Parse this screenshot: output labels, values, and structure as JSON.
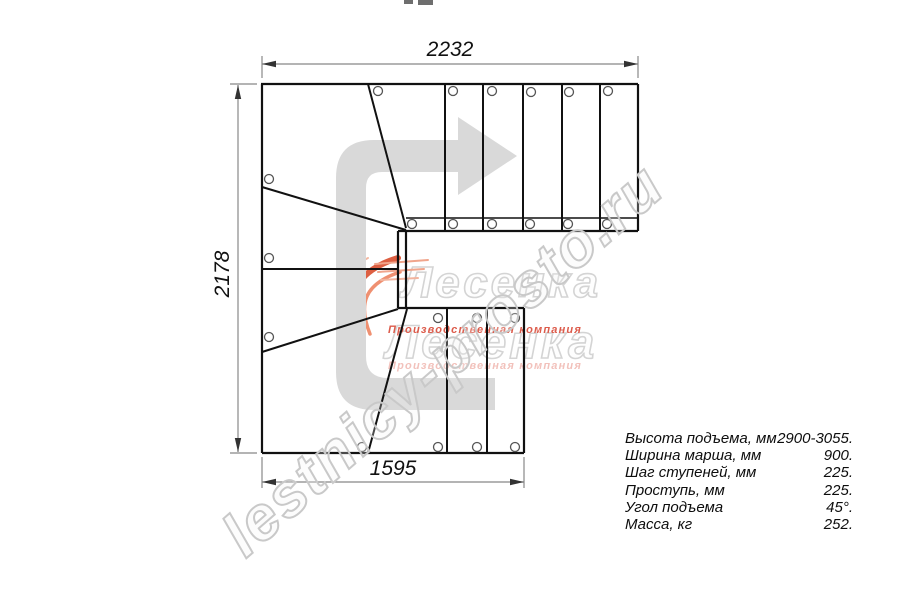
{
  "drawing": {
    "dimension_labels": {
      "top": "2232",
      "left": "2178",
      "bottom": "1595"
    },
    "spec_table": {
      "rows": [
        {
          "label": "Высота подъема, мм",
          "value": "2900-3055."
        },
        {
          "label": "Ширина марша, мм",
          "value": "900."
        },
        {
          "label": "Шаг ступеней, мм",
          "value": "225."
        },
        {
          "label": "Проступь, мм",
          "value": "225."
        },
        {
          "label": "Угол подъема",
          "value": "45°."
        },
        {
          "label": "Масса, кг",
          "value": "252."
        }
      ]
    },
    "watermarks": {
      "site": "lestnicy-prosto.ru",
      "logo_name": "Лесенка",
      "logo_caption": "Производственная компания"
    },
    "icons": {
      "direction_arrow": "u-turn-route-arrow"
    },
    "colors": {
      "plan_line": "#111111",
      "dimension_line": "#888888",
      "dimension_arrow": "#333333",
      "arrow_fill": "#d9d9d9",
      "watermark_outline": "#c9c9c9",
      "logo_orange": "#dd5f42",
      "logo_caption_red": "#dc5b4b"
    }
  }
}
